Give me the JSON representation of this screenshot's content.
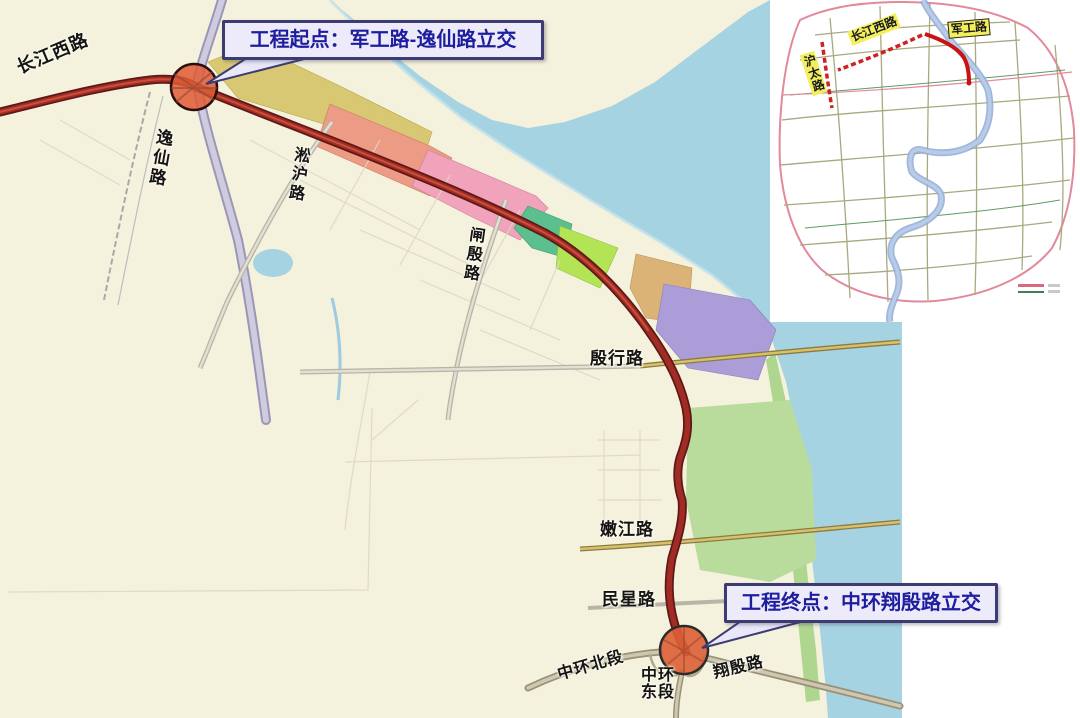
{
  "main_map": {
    "callouts": {
      "start": {
        "text": "工程起点：军工路-逸仙路立交"
      },
      "end": {
        "text": "工程终点：中环翔殷路立交"
      }
    },
    "road_labels": [
      {
        "id": "changjiang-xi-lu",
        "text": "长江西路"
      },
      {
        "id": "yixian-lu",
        "text": "逸仙路"
      },
      {
        "id": "songhu-lu",
        "text": "淞沪路"
      },
      {
        "id": "zhayin-lu",
        "text": "闸殷路"
      },
      {
        "id": "yinhang-lu",
        "text": "殷行路"
      },
      {
        "id": "nenjiang-lu",
        "text": "嫩江路"
      },
      {
        "id": "minxing-lu",
        "text": "民星路"
      },
      {
        "id": "zhonghuan-beiduan",
        "text": "中环北段"
      },
      {
        "id": "zhonghuan-dongduan",
        "text": "中环东段"
      },
      {
        "id": "xiangyin-lu",
        "text": "翔殷路"
      }
    ],
    "colors": {
      "route": "#8a2420",
      "water": "#a6d3e2",
      "land": "#f4f1dd",
      "interchange_fill": "#e05a34",
      "callout_text": "#1d1d9e",
      "parcel_yellow": "#d9c873",
      "parcel_salmon": "#ec9b84",
      "parcel_pink": "#f0a3bb",
      "parcel_teal_green": "#5bbf8e",
      "parcel_bright_green": "#b2e455",
      "parcel_tan": "#dcb377",
      "parcel_purple": "#ab9ed8",
      "park_green": "#b9db9b"
    }
  },
  "inset_map": {
    "labels": [
      {
        "id": "changjiang-xi-lu",
        "text": "长江西路"
      },
      {
        "id": "jungong-lu",
        "text": "军工路"
      },
      {
        "id": "hutai-lu",
        "text": "沪太路"
      }
    ],
    "legend": [
      {
        "color": "#d96a7e",
        "label": ""
      },
      {
        "color": "#3f7f52",
        "label": ""
      }
    ],
    "colors": {
      "boundary": "#e2899b",
      "river": "#8fabd8",
      "highlight_route": "#cc1111",
      "label_bg": "#f2ee5e"
    }
  }
}
